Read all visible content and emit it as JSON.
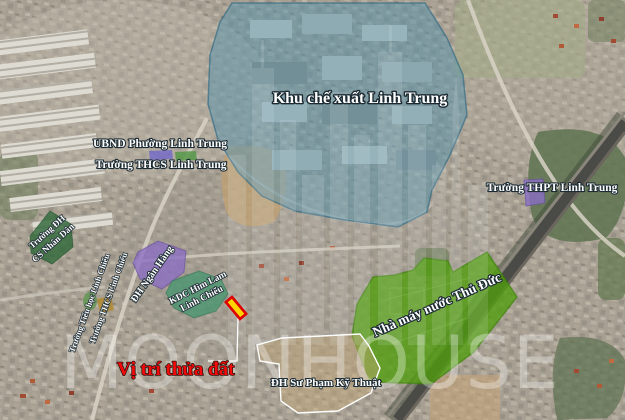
{
  "map": {
    "title_zone": "Khu chế xuất Linh Trung",
    "labels": {
      "kcx": "Khu chế xuất Linh Trung",
      "ubnd": "UBND Phường Linh Trung",
      "thcs_linh_trung": "Trường THCS Linh Trung",
      "thpt_linh_trung": "Trường THPT Linh Trung",
      "nha_may_nuoc": "Nhà máy nước Thủ Đức",
      "dh_ngan_hang": "ĐH Ngân Hàng",
      "kdc_line1": "KDC Him Lam",
      "kdc_line2": "Linh Chiểu",
      "csnd_line1": "Trường ĐH",
      "csnd_line2": "CS Nhân Dân",
      "th_linh_chieu": "Trường Tiểu học Linh Chiểu",
      "thcs_linh_chieu": "Trường THCS Linh Chiểu",
      "dh_spkt": "ĐH Sư Phạm Kỹ Thuật",
      "vi_tri_thua_dat": "Vị trí thửa đất"
    },
    "watermark": "MOONHOUSE",
    "colors": {
      "export_zone_fill": "#5894ac",
      "water_plant_fill": "#50a00c",
      "university_purple": "#8a6ec4",
      "residential_teal": "#46966e",
      "school_dark_green": "#326940",
      "market_olive": "#b08a30",
      "marker_fill": "#ffd400",
      "marker_border": "#dd0000",
      "highlight_text": "#ff0000"
    }
  }
}
